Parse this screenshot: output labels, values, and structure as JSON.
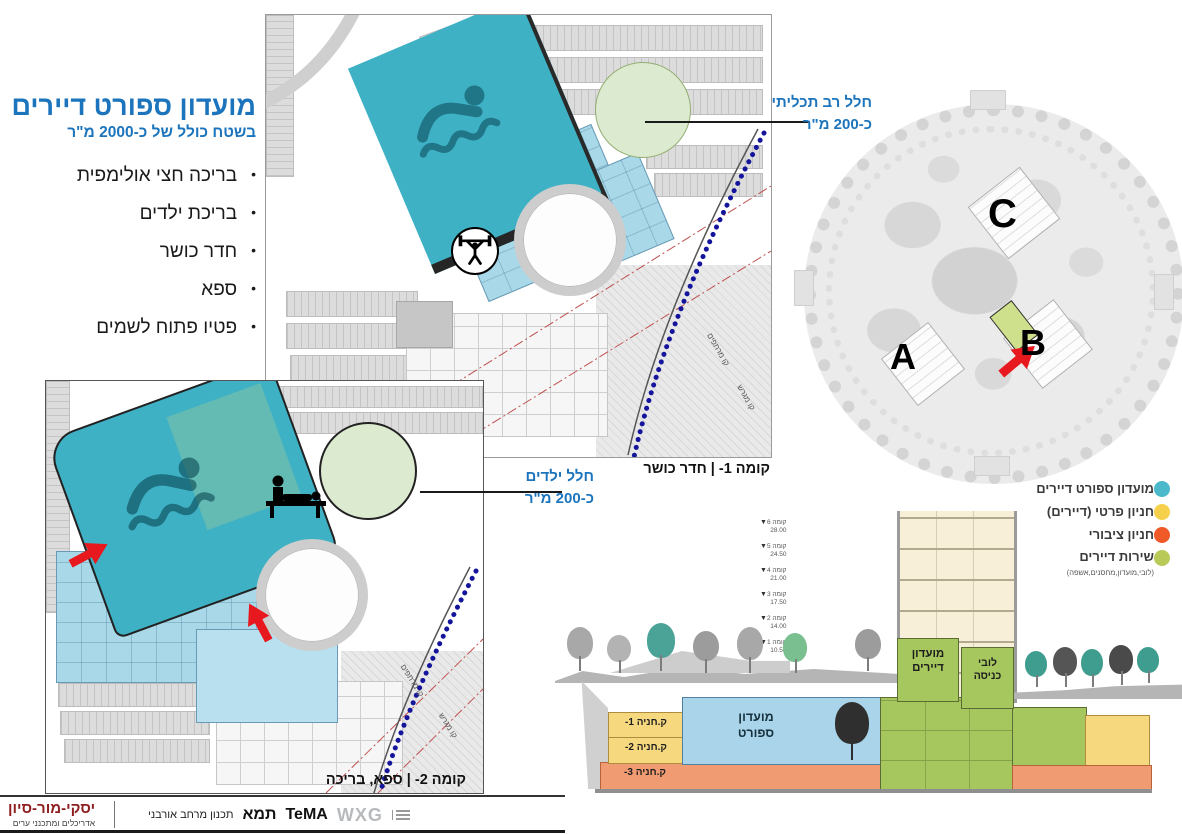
{
  "title_block": {
    "title": "מועדון ספורט דיירים",
    "subtitle": "בשטח כולל של כ-2000 מ\"ר",
    "bullets": [
      "בריכה חצי אולימפית",
      "בריכת ילדים",
      "חדר כושר",
      "ספא",
      "פטיו פתוח לשמים"
    ],
    "bullet_char": "•"
  },
  "plans": {
    "plan1": {
      "caption": "קומה 1- | חדר כושר",
      "callout_line1": "חלל רב תכליתי",
      "callout_line2": "כ-200 מ\"ר",
      "label_basement_line": "קו מרתפים",
      "label_lot_line": "קו מגרש"
    },
    "plan2": {
      "caption": "קומה 2- | ספא, בריכה",
      "callout_line1": "חלל ילדים",
      "callout_line2": "כ-200 מ\"ר",
      "label_basement_line": "קו מרתפים",
      "label_lot_line": "קו מגרש"
    }
  },
  "site_plan": {
    "label_a": "A",
    "label_b": "B",
    "label_c": "C"
  },
  "legend": {
    "items": [
      {
        "label": "מועדון ספורט דיירים",
        "color": "#4BB9CB"
      },
      {
        "label": "חניון פרטי (דיירים)",
        "color": "#F6D04B"
      },
      {
        "label": "חניון ציבורי",
        "color": "#F05A28"
      },
      {
        "label": "שירות דיירים",
        "sub": "(לובי,מועדון,מחסנים,אשפה)",
        "color": "#B9CA58"
      }
    ]
  },
  "section": {
    "levels": [
      {
        "name": "קומה 6",
        "value": "28.00"
      },
      {
        "name": "קומה 5",
        "value": "24.50"
      },
      {
        "name": "קומה 4",
        "value": "21.00"
      },
      {
        "name": "קומה 3",
        "value": "17.50"
      },
      {
        "name": "קומה 2",
        "value": "14.00"
      },
      {
        "name": "קומה 1",
        "value": "10.50"
      }
    ],
    "residents_club_line1": "מועדון",
    "residents_club_line2": "דיירים",
    "lobby_line1": "לובי",
    "lobby_line2": "כניסה",
    "sport_line1": "מועדון",
    "sport_line2": "ספורט",
    "parking_labels": [
      "ק.חניה 1-",
      "ק.חניה 2-",
      "ק.חניה 3-"
    ]
  },
  "footer": {
    "firm_name": "יסקי-מור-סיון",
    "firm_subtitle": "אדריכלים ומתכנני ערים",
    "tema_tagline": "תכנון מרחב אורבני",
    "tema_he": "תמא",
    "tema_en": "TeMA",
    "wxg": "WXG"
  },
  "colors": {
    "title_blue": "#1C75BC",
    "pool_teal": "#3FB1C5",
    "club_light_blue": "#A9D9E8",
    "green_circle": "#DCEAD0",
    "section_green": "#A6C75E",
    "section_yellow": "#F6D97F",
    "section_orange": "#F19B72",
    "red_arrow": "#E8191E",
    "firm_maroon": "#8E1D1F"
  }
}
